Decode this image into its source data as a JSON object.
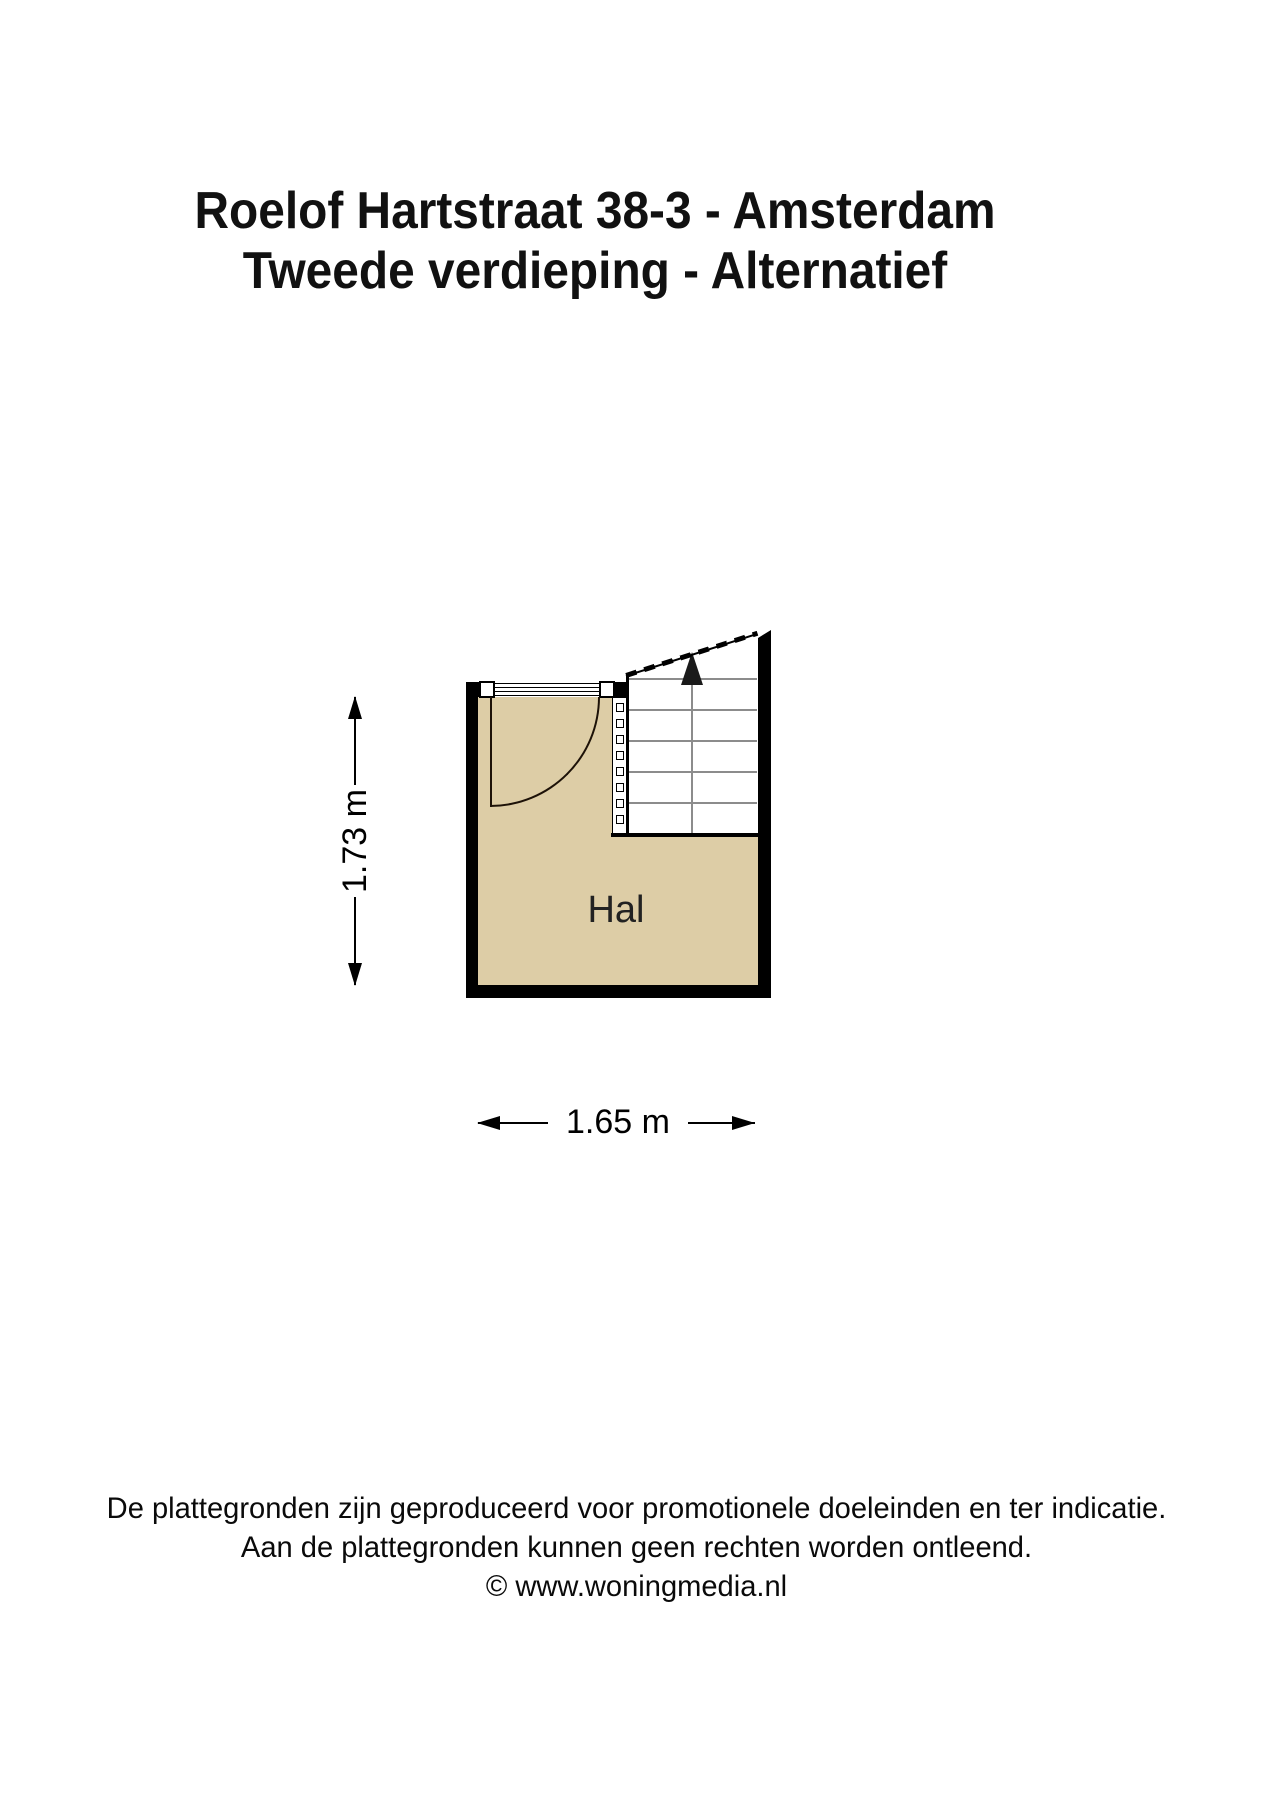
{
  "title": {
    "line1": "Roelof Hartstraat 38-3 - Amsterdam",
    "line2": "Tweede verdieping - Alternatief"
  },
  "floorplan": {
    "room_label": "Hal",
    "width_m": 1.65,
    "height_m": 1.73,
    "width_label": "1.65 m",
    "height_label": "1.73 m",
    "features": [
      "door-swing",
      "staircase-up",
      "railing-balusters"
    ]
  },
  "footer": {
    "lines": [
      "De plattegronden zijn geproduceerd voor promotionele doeleinden en ter indicatie.",
      "Aan de plattegronden kunnen geen rechten worden ontleend.",
      "© www.woningmedia.nl"
    ]
  },
  "colors": {
    "background": "#ffffff",
    "wall": "#000000",
    "floor": "#ddcda6",
    "tread": "#8c8c8c"
  }
}
